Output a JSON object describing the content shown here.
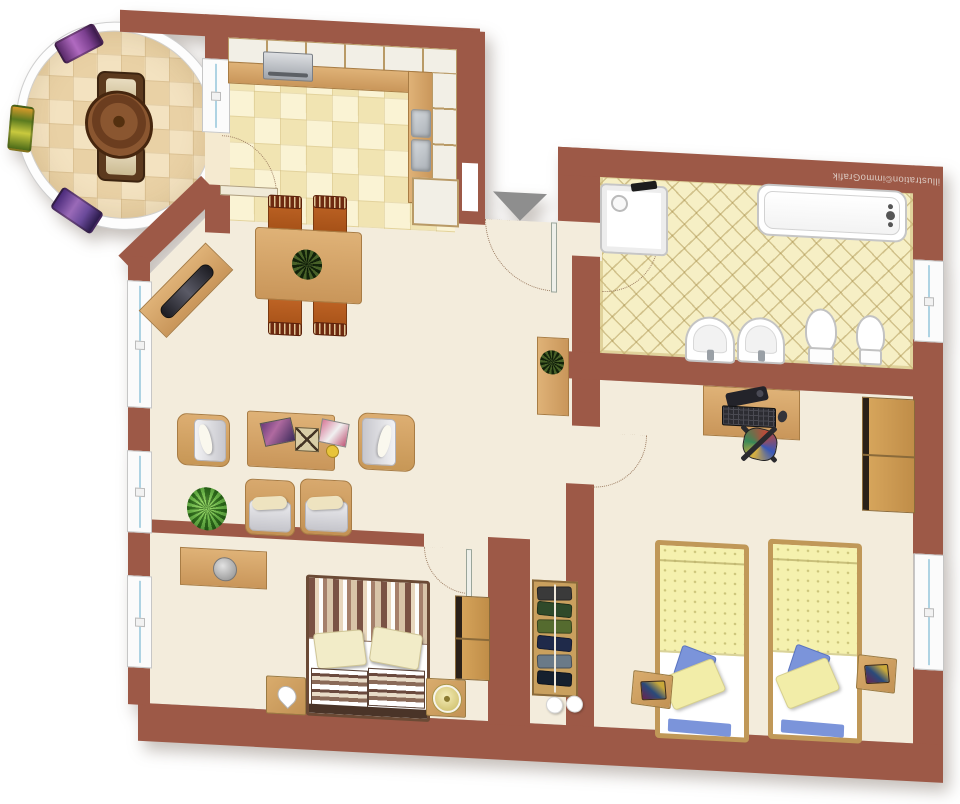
{
  "watermark": "illustration©immoGrafik",
  "colors": {
    "wall": "#9d5947",
    "floor": "#f3ecdc",
    "kitchen_tile_a": "#faf3d4",
    "kitchen_tile_b": "#f1e4b2",
    "bath_tile": "#f6efc5",
    "balcony_tile_a": "#f3e2c0",
    "balcony_tile_b": "#e9d1a5",
    "glass": "#aed3e3",
    "outline": "#9b7b60",
    "arrow_gray": "#8e8e8e",
    "bed_yellow": "#f5f1ae",
    "pillow_blue": "#7b94da",
    "plant_green": "#4e9a31"
  },
  "rooms": {
    "balcony": {
      "furniture": [
        "round-table",
        "two-chairs",
        "three-flower-boxes"
      ]
    },
    "kitchen": {
      "furniture": [
        "l-shaped-counter",
        "stove",
        "double-sink",
        "cabinets"
      ]
    },
    "bathroom": {
      "furniture": [
        "shower",
        "bathtub",
        "two-washbasins",
        "toilet",
        "bidet"
      ]
    },
    "living-room": {
      "furniture": [
        "dining-table",
        "four-dining-chairs",
        "sideboard",
        "four-armchairs",
        "coffee-table",
        "plant",
        "cabinet-with-plant"
      ]
    },
    "bedroom": {
      "furniture": [
        "double-bed",
        "two-nightstands",
        "wall-shelf",
        "wardrobe"
      ]
    },
    "kids-room": {
      "furniture": [
        "desk",
        "office-chair",
        "wardrobe",
        "two-single-beds",
        "two-nightstands"
      ]
    },
    "hallway": {
      "furniture": [
        "built-in-wardrobe"
      ]
    }
  }
}
